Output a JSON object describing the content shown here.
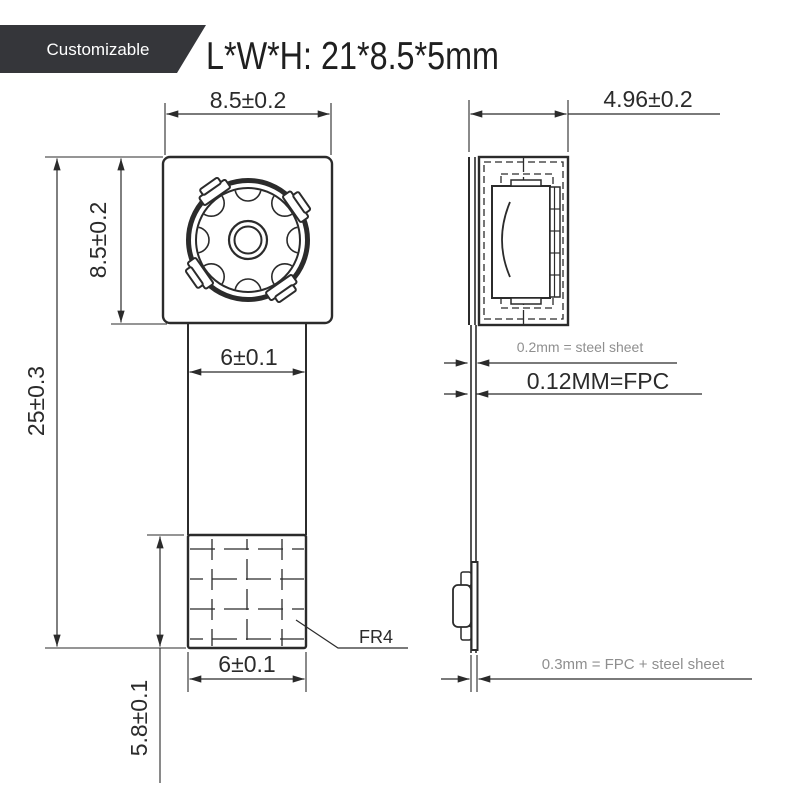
{
  "badge": {
    "label": "Customizable"
  },
  "header": {
    "title": "L*W*H: 21*8.5*5mm"
  },
  "front_view": {
    "dims": {
      "width_top": "8.5±0.2",
      "height_left": "8.5±0.2",
      "total_height": "25±0.3",
      "fpc_width": "6±0.1",
      "stiffener_width": "6±0.1",
      "stiffener_height": "5.8±0.1"
    },
    "labels": {
      "stiffener": "FR4"
    }
  },
  "side_view": {
    "dims": {
      "module_thickness": "4.96±0.2"
    },
    "callouts": {
      "steel_sheet": "0.2mm = steel sheet",
      "fpc": "0.12MM=FPC",
      "fpc_steel_total": "0.3mm = FPC + steel sheet"
    }
  },
  "colors": {
    "line": "#2b2b2b",
    "muted_text": "#8f8f8f",
    "badge_bg": "#35363a",
    "title_text": "#1f1f1f"
  }
}
